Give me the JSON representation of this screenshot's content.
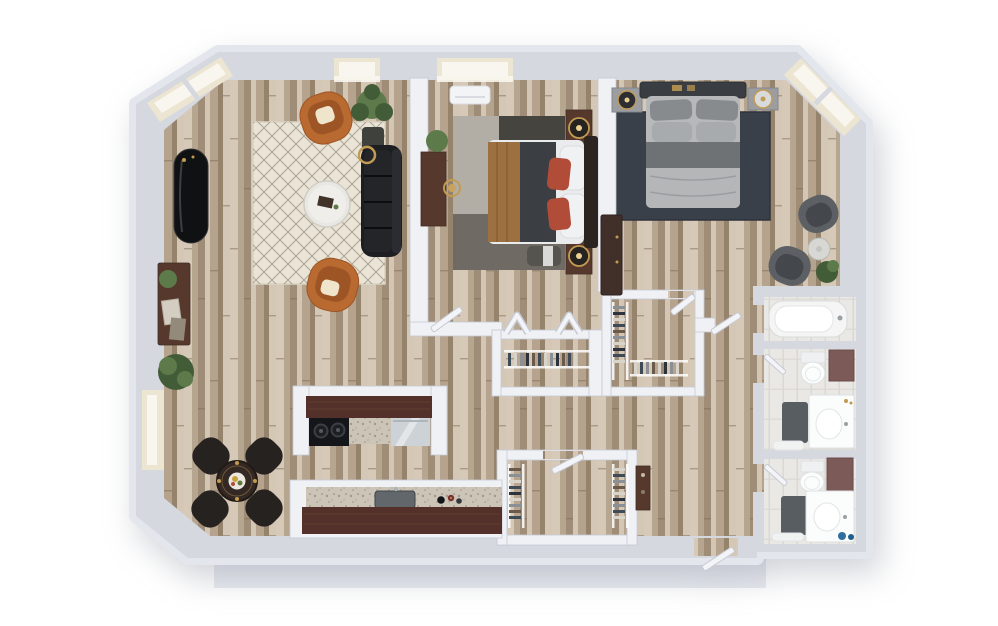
{
  "scene": {
    "description": "3D top-down rendered floor plan of a two-bedroom two-bathroom apartment with angled window corners",
    "floor_material": "light oak plank",
    "no_visible_text": true
  },
  "palette": {
    "wall": "#d6d8e0",
    "wallFace": "#e4e6ed",
    "wallInner": "#eff1f5",
    "wallStroke": "#c7cad4",
    "woodBase": "#c5b4a0",
    "woodLight": "#d6c9b7",
    "woodMid": "#b5a38d",
    "woodDark": "#a08d77",
    "woodDeep": "#8a775f",
    "tile": "#eae8e4",
    "tileLine": "#dbd8d2",
    "cream": "#ece5d1",
    "glass": "#f8f6ee",
    "rugLiving": "#e9e4d6",
    "rugLatticeColor": "#94897a",
    "rugB1a": "#b3aea5",
    "rugB1b": "#45443e",
    "rugB1c": "#6f6b64",
    "rugB2": "#394049",
    "sofa": "#1d1e22",
    "orange": "#b96a30",
    "orangeDeep": "#9d5525",
    "pillowCream": "#eee5cb",
    "counterBrown": "#53312a",
    "granite": "#ccc5b7",
    "graniteDot": "#968e7e",
    "steel": "#ccd2d5",
    "stove": "#141619",
    "burner": "#3c4046",
    "plant": "#5d7a4a",
    "plantDeep": "#425c37",
    "pot": "#3f413d",
    "gold": "#c29b52",
    "bedWhite": "#eaebec",
    "bedGrayLight": "#b6b8b9",
    "bedGrayMid": "#84878a",
    "bedGrayDark": "#55585c",
    "headboard": "#3a3d41",
    "bedTan": "#9c7040",
    "redPillow": "#b14c39",
    "woodFurn": "#56392c",
    "woodFurnDark": "#3f2d24",
    "grayChair": "#5c6064",
    "grayChairDeep": "#44484c",
    "marble": "#d7d7d4",
    "mauve": "#7c5a58",
    "matDark": "#585d62",
    "matLight": "#f1f2f2",
    "porcelain": "#fbfcfc",
    "porcelainStroke": "#dde0e2",
    "blackGloss": "#141518",
    "blue": "#2f6e9e",
    "shadow": "#e9ebf1"
  },
  "rooms": [
    {
      "id": "living-room",
      "furniture": [
        "diamond-lattice-area-rug",
        "round-marble-coffee-table",
        "black-sofa",
        "orange-armchair-top",
        "orange-armchair-bottom",
        "tall-floor-plant",
        "black-console-table",
        "sideboard-with-decor",
        "shrub-plant",
        "brass-arc-floor-lamp"
      ]
    },
    {
      "id": "dining-area",
      "furniture": [
        "round-dining-table",
        "dining-chair-nw",
        "dining-chair-ne",
        "dining-chair-sw",
        "dining-chair-se"
      ]
    },
    {
      "id": "kitchen",
      "furniture": [
        "peninsula-counter",
        "cooktop-two-burners",
        "granite-worktop",
        "glass-front-appliance",
        "base-counter",
        "kitchen-sink",
        "bottles"
      ]
    },
    {
      "id": "bedroom-1",
      "furniture": [
        "double-bed-tan-and-gray",
        "dark-headboard",
        "nightstand-top",
        "nightstand-bottom",
        "gold-ring-lamp-top",
        "gold-ring-lamp-bottom",
        "patchwork-gray-rug",
        "wall-desk",
        "desk-chair",
        "potted-plant",
        "ac-unit",
        "foot-bench"
      ]
    },
    {
      "id": "bedroom-2",
      "furniture": [
        "double-bed-gray",
        "gray-headboard",
        "nightstand-left",
        "nightstand-right",
        "table-lamp-left",
        "table-lamp-right",
        "dark-navy-rug",
        "gray-armchair-upper",
        "gray-armchair-lower",
        "round-marble-side-table",
        "potted-plant",
        "tall-dresser"
      ]
    },
    {
      "id": "walk-in-closet-left",
      "furniture": [
        "wire-shelving",
        "hanging-clothes",
        "bifold-doors"
      ]
    },
    {
      "id": "walk-in-closet-right",
      "furniture": [
        "wire-shelving-left",
        "wire-shelving-bottom",
        "hanging-clothes",
        "hinged-door"
      ]
    },
    {
      "id": "entry-closet",
      "furniture": [
        "wire-shelving-left",
        "wire-shelving-right",
        "hanging-clothes",
        "hinged-door"
      ]
    },
    {
      "id": "bathtub-room",
      "furniture": [
        "bathtub"
      ]
    },
    {
      "id": "bathroom-1",
      "furniture": [
        "toilet",
        "storage-cabinet",
        "vanity-with-sink",
        "dark-bath-mat",
        "white-bath-mat"
      ]
    },
    {
      "id": "bathroom-2",
      "furniture": [
        "toilet",
        "storage-cabinet",
        "vanity-with-sink",
        "dark-bath-mat",
        "white-bath-mat",
        "blue-bottles"
      ]
    },
    {
      "id": "hallway",
      "furniture": [
        "storage-shelf",
        "entry-door"
      ]
    }
  ],
  "windows": [
    "top-left-corner-bay",
    "top-right-corner-bay",
    "living-room-top",
    "bedroom-1-top",
    "left-wall-dining"
  ],
  "doors": [
    "bedroom-1-door",
    "closet-left-bifold-pair",
    "closet-right-door",
    "entry-closet-door",
    "corridor-door",
    "bathroom-1-door",
    "bathroom-2-door",
    "apartment-entry-door"
  ]
}
